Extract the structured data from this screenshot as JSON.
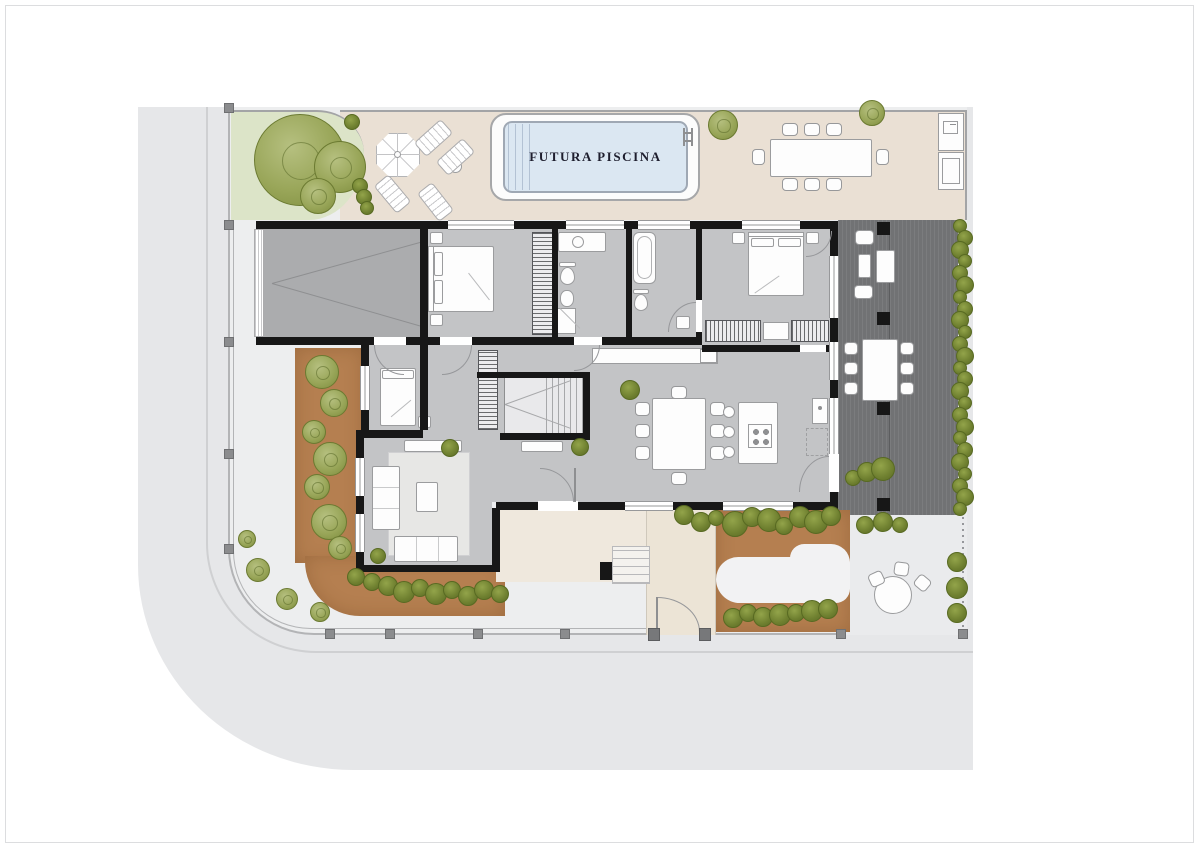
{
  "plan": {
    "pool_label": "FUTURA PISCINA"
  },
  "palette": {
    "page-bg": "#ffffff",
    "road": "#e6e7e9",
    "yard": "#edeeef",
    "terrace": "#eae0d4",
    "garden": "#dce4c8",
    "pool": "#dbe7f2",
    "floor": "#c3c4c6",
    "garage": "#abacae",
    "wall": "#171717",
    "deck": "#717274",
    "bed": "#b57f50"
  }
}
